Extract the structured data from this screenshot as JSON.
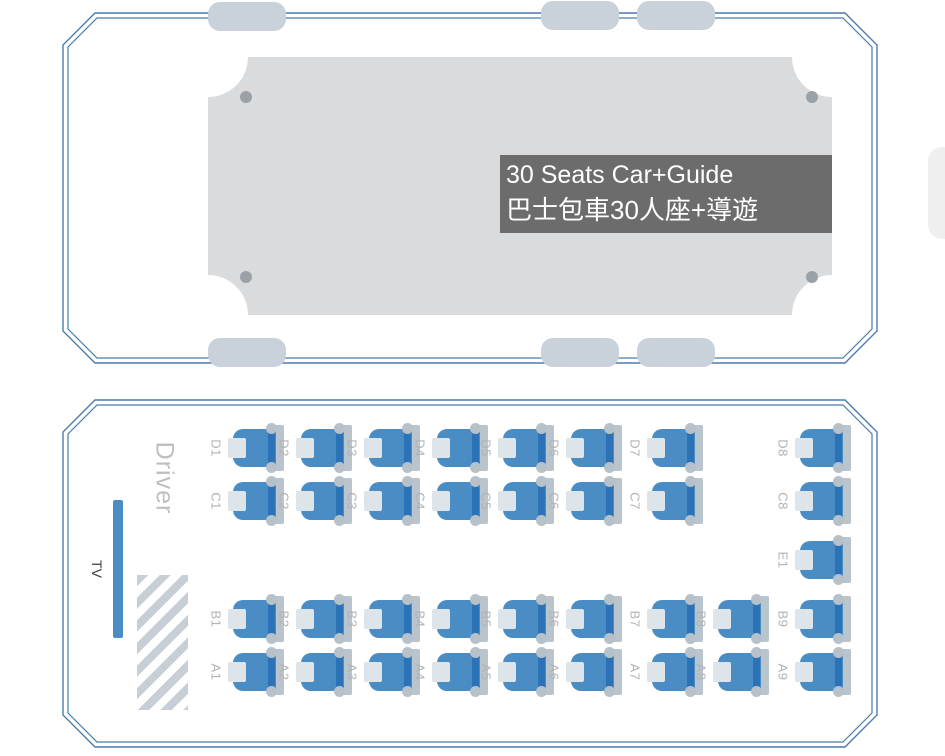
{
  "top_bus": {
    "label_line1": "30 Seats Car+Guide",
    "label_line2": "巴士包車30人座+導遊"
  },
  "cabin": {
    "driver_label": "Driver",
    "tv_label": "TV",
    "seats": [
      {
        "id": "D1",
        "row": "D",
        "col": 1
      },
      {
        "id": "D2",
        "row": "D",
        "col": 2
      },
      {
        "id": "D3",
        "row": "D",
        "col": 3
      },
      {
        "id": "D4",
        "row": "D",
        "col": 4
      },
      {
        "id": "D5",
        "row": "D",
        "col": 5
      },
      {
        "id": "D6",
        "row": "D",
        "col": 6
      },
      {
        "id": "D7",
        "row": "D",
        "col": 7
      },
      {
        "id": "D8",
        "row": "D",
        "col": 9
      },
      {
        "id": "C1",
        "row": "C",
        "col": 1
      },
      {
        "id": "C2",
        "row": "C",
        "col": 2
      },
      {
        "id": "C3",
        "row": "C",
        "col": 3
      },
      {
        "id": "C4",
        "row": "C",
        "col": 4
      },
      {
        "id": "C5",
        "row": "C",
        "col": 5
      },
      {
        "id": "C6",
        "row": "C",
        "col": 6
      },
      {
        "id": "C7",
        "row": "C",
        "col": 7
      },
      {
        "id": "C8",
        "row": "C",
        "col": 9
      },
      {
        "id": "E1",
        "row": "E",
        "col": 9
      },
      {
        "id": "B1",
        "row": "B",
        "col": 1
      },
      {
        "id": "B2",
        "row": "B",
        "col": 2
      },
      {
        "id": "B3",
        "row": "B",
        "col": 3
      },
      {
        "id": "B4",
        "row": "B",
        "col": 4
      },
      {
        "id": "B5",
        "row": "B",
        "col": 5
      },
      {
        "id": "B6",
        "row": "B",
        "col": 6
      },
      {
        "id": "B7",
        "row": "B",
        "col": 7
      },
      {
        "id": "B8",
        "row": "B",
        "col": 8
      },
      {
        "id": "B9",
        "row": "B",
        "col": 9
      },
      {
        "id": "A1",
        "row": "A",
        "col": 1
      },
      {
        "id": "A2",
        "row": "A",
        "col": 2
      },
      {
        "id": "A3",
        "row": "A",
        "col": 3
      },
      {
        "id": "A4",
        "row": "A",
        "col": 4
      },
      {
        "id": "A5",
        "row": "A",
        "col": 5
      },
      {
        "id": "A6",
        "row": "A",
        "col": 6
      },
      {
        "id": "A7",
        "row": "A",
        "col": 7
      },
      {
        "id": "A8",
        "row": "A",
        "col": 8
      },
      {
        "id": "A9",
        "row": "A",
        "col": 9
      }
    ]
  },
  "colors": {
    "outline_blue": "#4a7cad",
    "seat_blue": "#4a8dc4",
    "seat_dark_blue": "#2b72b6",
    "wheel_gray": "#c9d2db",
    "roof_gray": "#d9dbdd",
    "label_box_bg": "#5c5c5c",
    "label_text": "#ffffff",
    "muted_label_gray": "#b2b2b2"
  }
}
